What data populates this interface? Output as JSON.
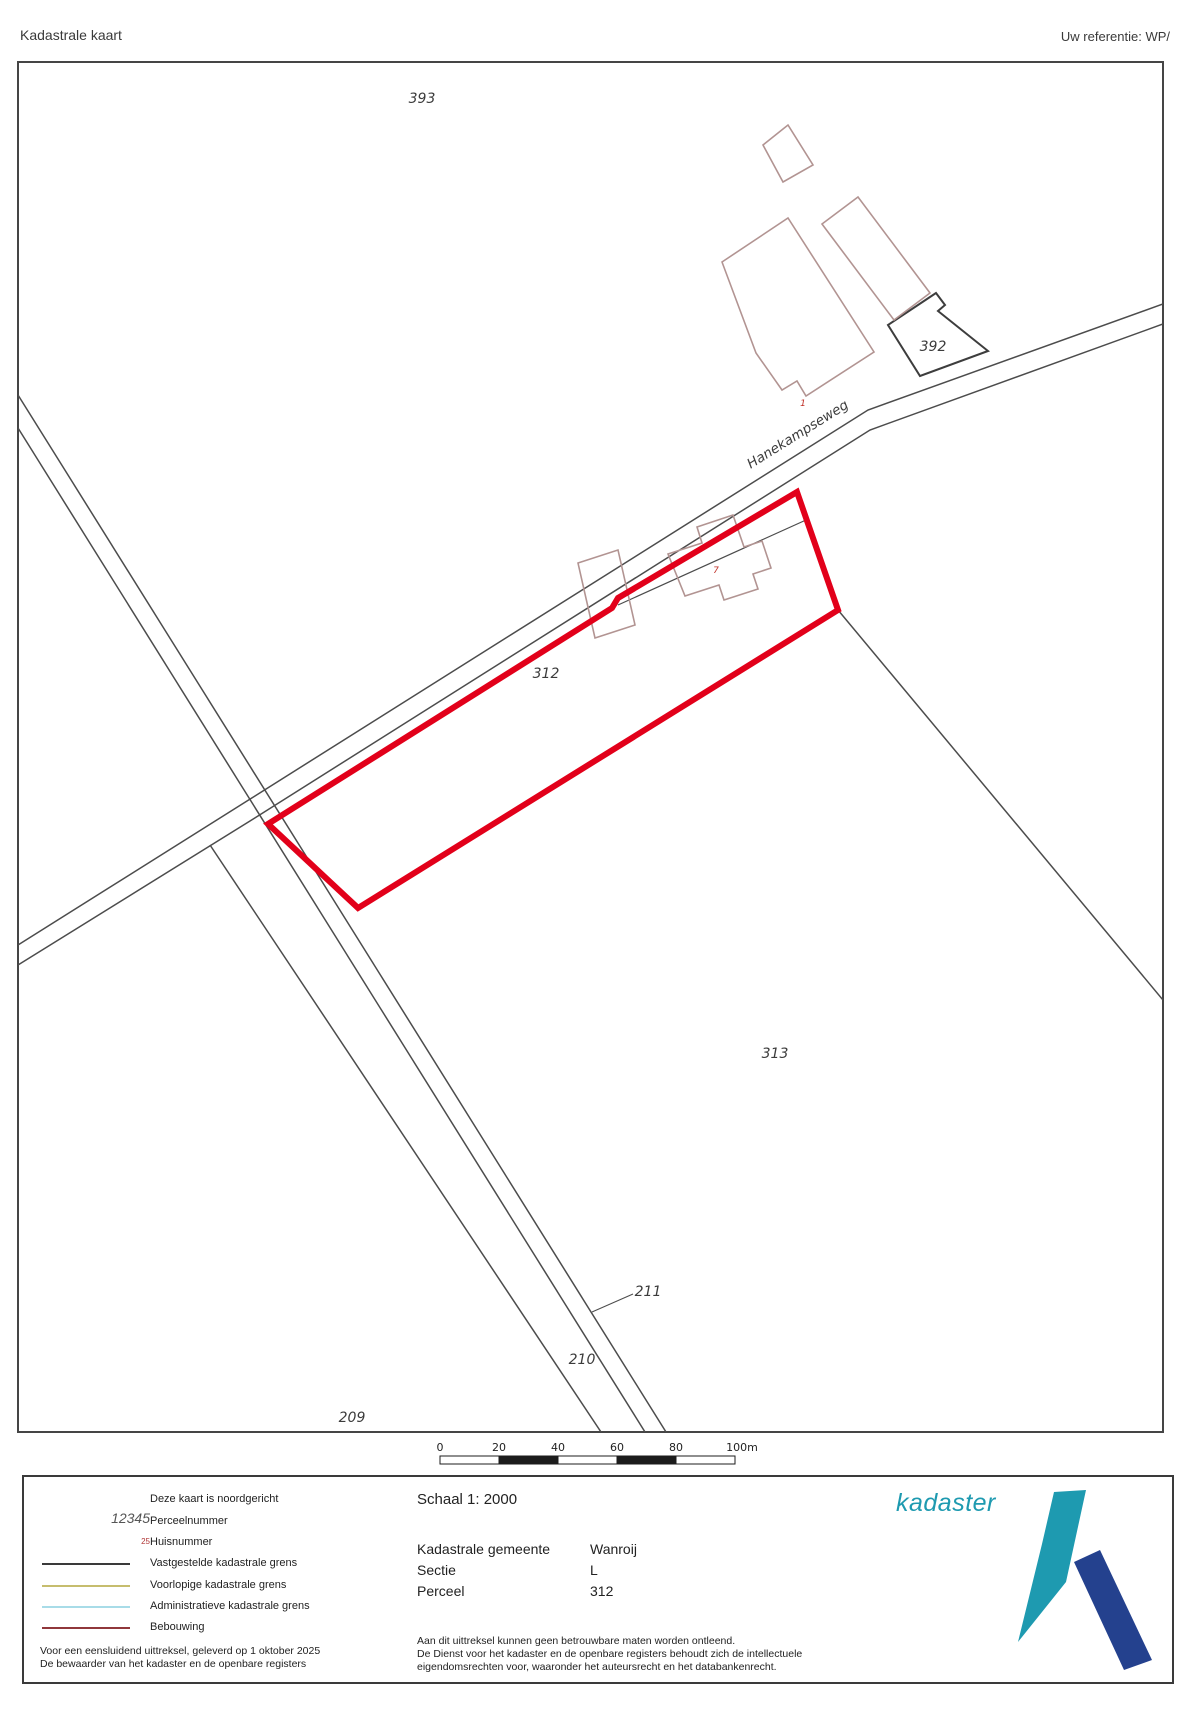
{
  "header": {
    "title": "Kadastrale kaart",
    "reference": "Uw referentie: WP/"
  },
  "map": {
    "road_label": "Hanekampseweg",
    "parcels": [
      "393",
      "392",
      "312",
      "313",
      "211",
      "210",
      "209"
    ],
    "house_numbers": [
      "1",
      "7"
    ],
    "selected_parcel_number": "312",
    "colors": {
      "selected_parcel_outline": "#e2001a",
      "building_outline": "#b29492",
      "boundary_line": "#4c4c4c"
    }
  },
  "scalebar": {
    "ticks": [
      "0",
      "20",
      "40",
      "60",
      "80",
      "100m"
    ]
  },
  "legend": {
    "north_note": "Deze kaart is noordgericht",
    "items": [
      {
        "symbol": "12345",
        "label": "Perceelnummer"
      },
      {
        "symbol": "25",
        "label": "Huisnummer"
      },
      {
        "label": "Vastgestelde kadastrale grens",
        "color": "#3a3a3a"
      },
      {
        "label": "Voorlopige kadastrale grens",
        "color": "#c6bd6e"
      },
      {
        "label": "Administratieve kadastrale grens",
        "color": "#a8dce8"
      },
      {
        "label": "Bebouwing",
        "color": "#90373b"
      }
    ],
    "footer_lines": [
      "Voor een eensluidend uittreksel, geleverd op 1 oktober 2025",
      "De bewaarder van het kadaster en de openbare registers"
    ]
  },
  "details": {
    "scale": "Schaal 1: 2000",
    "rows": [
      {
        "label": "Kadastrale gemeente",
        "value": "Wanroij"
      },
      {
        "label": "Sectie",
        "value": "L"
      },
      {
        "label": "Perceel",
        "value": "312"
      }
    ],
    "disclaimer": [
      "Aan dit uittreksel kunnen geen betrouwbare maten worden ontleend.",
      "De Dienst voor het kadaster en de openbare registers behoudt zich de intellectuele",
      "eigendomsrechten voor, waaronder het auteursrecht en het databankenrecht."
    ]
  },
  "logo": {
    "text": "kadaster",
    "teal": "#1e9ab0",
    "navy": "#24418e"
  }
}
